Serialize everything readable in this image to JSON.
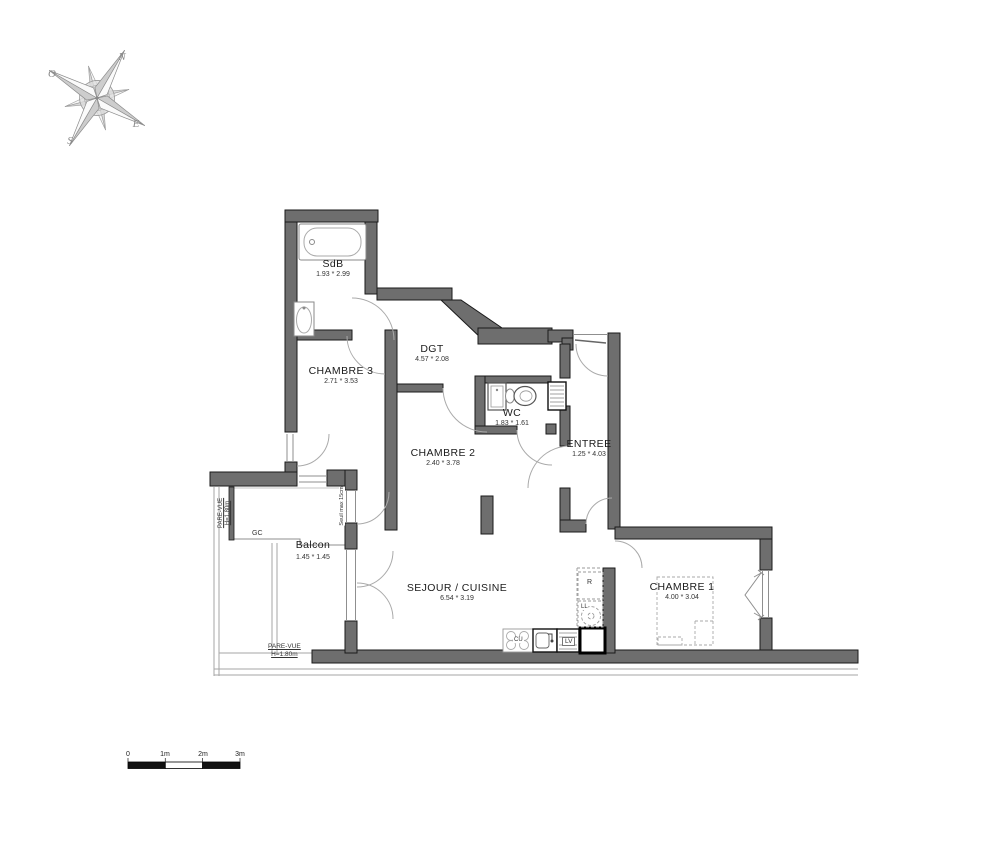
{
  "plan": {
    "rooms": [
      {
        "name": "SdB",
        "dims": "1.93 * 2.99"
      },
      {
        "name": "DGT",
        "dims": "4.57 * 2.08"
      },
      {
        "name": "CHAMBRE 3",
        "dims": "2.71 * 3.53"
      },
      {
        "name": "WC",
        "dims": "1.83 * 1.61"
      },
      {
        "name": "ENTREE",
        "dims": "1.25 * 4.03"
      },
      {
        "name": "CHAMBRE 2",
        "dims": "2.40 * 3.78"
      },
      {
        "name": "Balcon",
        "dims": "1.45 * 1.45"
      },
      {
        "name": "SEJOUR / CUISINE",
        "dims": "6.54 * 3.19"
      },
      {
        "name": "CHAMBRE 1",
        "dims": "4.00 * 3.04"
      }
    ],
    "annotations": {
      "gc": "GC",
      "cu": "CU",
      "lv": "LV",
      "r": "R",
      "ll": "LL",
      "seuil": "Seuil max 15cm",
      "pare_vue_left_1": "PARE-VUE",
      "pare_vue_left_2": "H=1.80m",
      "pare_vue_bottom_1": "PARE-VUE",
      "pare_vue_bottom_2": "H=1.80m"
    },
    "compass": {
      "n": "N",
      "o": "O",
      "e": "E",
      "s": "S"
    },
    "scale": {
      "t0": "0",
      "t1": "1m",
      "t2": "2m",
      "t3": "3m"
    },
    "colors": {
      "wall": "#6e6e6e",
      "outline": "#1a1a1a",
      "thin": "#999999"
    }
  }
}
